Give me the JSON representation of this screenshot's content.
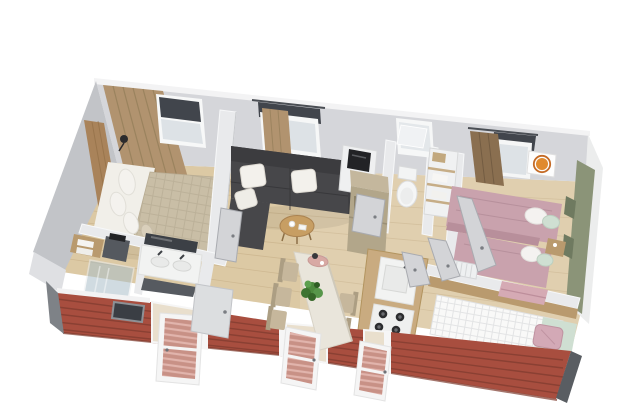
{
  "scene": {
    "type": "3d-floorplan-render",
    "subject": "perspective cutaway rendering of a small holiday home interior with red lap siding",
    "background": "#ffffff"
  },
  "palette": {
    "floor_wood": "#dcc9a4",
    "floor_plank_line": "#c4ad85",
    "wall_interior": "#d5d6da",
    "wall_cap": "#f3f3f4",
    "wall_exterior_gray": "#c2c4c8",
    "partition_white": "#e9eaec",
    "accent_wall_green": "#8b9478",
    "siding_red": "#a84e3f",
    "siding_stripe": "#8a4033",
    "corner_trim_gray": "#7e8287",
    "corner_trim_dark": "#595d62",
    "sofa_charcoal": "#47474a",
    "cushion_white": "#f3f1ec",
    "curtain_tan": "#b1936f",
    "curtain_brown": "#8a6f50",
    "duvet_beige": "#c9bea6",
    "duvet_pink": "#c9a2ad",
    "pillow_sage": "#cfdfd2",
    "pillow_pink": "#d3a9b6",
    "wood_furniture": "#b99a6e",
    "counter_wood": "#c9ab80",
    "appliance_taupe": "#b2a68a",
    "fixture_white": "#f2f3f2",
    "glass_blue": "#dde2e6",
    "door_gray": "#d3d4d7",
    "mirror_dark": "#3c4046",
    "plant_green": "#4d8a3e",
    "window_blind_dark": "#41454c"
  },
  "rooms": [
    {
      "id": "master-bedroom",
      "furniture": [
        "double bed",
        "wood headboard",
        "wall lamp",
        "wardrobe curtain",
        "window with dark blind"
      ]
    },
    {
      "id": "bathroom",
      "furniture": [
        "double-sink vanity",
        "dark mirror",
        "walk-in glass shower",
        "towel shelf",
        "dark storage unit",
        "low dark-framed window"
      ]
    },
    {
      "id": "living-room",
      "furniture": [
        "charcoal corner sofa",
        "three white cushions",
        "round wood coffee table",
        "window with tan curtain"
      ]
    },
    {
      "id": "dining-area",
      "furniture": [
        "long dining table",
        "five beige chairs",
        "potted plant",
        "pink tray with vase"
      ]
    },
    {
      "id": "kitchen",
      "furniture": [
        "wood counter with sink",
        "four-burner hob",
        "tall taupe fridge",
        "shelf with microwave"
      ]
    },
    {
      "id": "wc",
      "furniture": [
        "toilet",
        "tilt window",
        "shelving with towels and basket"
      ]
    },
    {
      "id": "bedroom-twin",
      "furniture": [
        "two single beds with pink duvets",
        "white and sage pillows",
        "wood nightstand",
        "radiator",
        "lion wall picture",
        "window with brown curtain"
      ]
    },
    {
      "id": "bedroom-single",
      "furniture": [
        "single bed with white quilted cover",
        "pink pillow",
        "mint throw",
        "folded pink blanket",
        "wood headboard ledge"
      ]
    }
  ],
  "exterior": {
    "siding": "red horizontal lap siding",
    "front_openings": [
      "glazed door left",
      "glazed door centre",
      "glazed door right",
      "low dark window"
    ],
    "corner_trims": 2,
    "back_wall_windows": 4
  }
}
